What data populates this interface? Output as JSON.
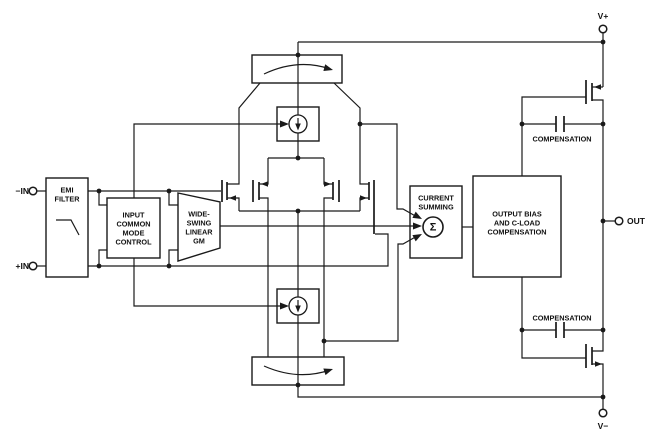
{
  "diagram": {
    "title": "amplifier functional block diagram",
    "colors": {
      "line": "#1a1a1a",
      "background": "#ffffff",
      "text": "#111111"
    },
    "terminals": {
      "in_neg": "−IN",
      "in_pos": "+IN",
      "v_plus": "V+",
      "v_minus": "V−",
      "out": "OUT"
    },
    "blocks": {
      "emi": {
        "lines": [
          "EMI",
          "FILTER"
        ]
      },
      "icm": {
        "lines": [
          "INPUT",
          "COMMON",
          "MODE",
          "CONTROL"
        ]
      },
      "gm": {
        "lines": [
          "WIDE-",
          "SWING",
          "LINEAR",
          "GM"
        ]
      },
      "summing": {
        "lines": [
          "CURRENT",
          "SUMMING"
        ],
        "sigma": "Σ"
      },
      "output_bias": {
        "lines": [
          "OUTPUT BIAS",
          "AND C-LOAD",
          "COMPENSATION"
        ]
      },
      "comp_top": {
        "label": "COMPENSATION"
      },
      "comp_bottom": {
        "label": "COMPENSATION"
      }
    }
  }
}
